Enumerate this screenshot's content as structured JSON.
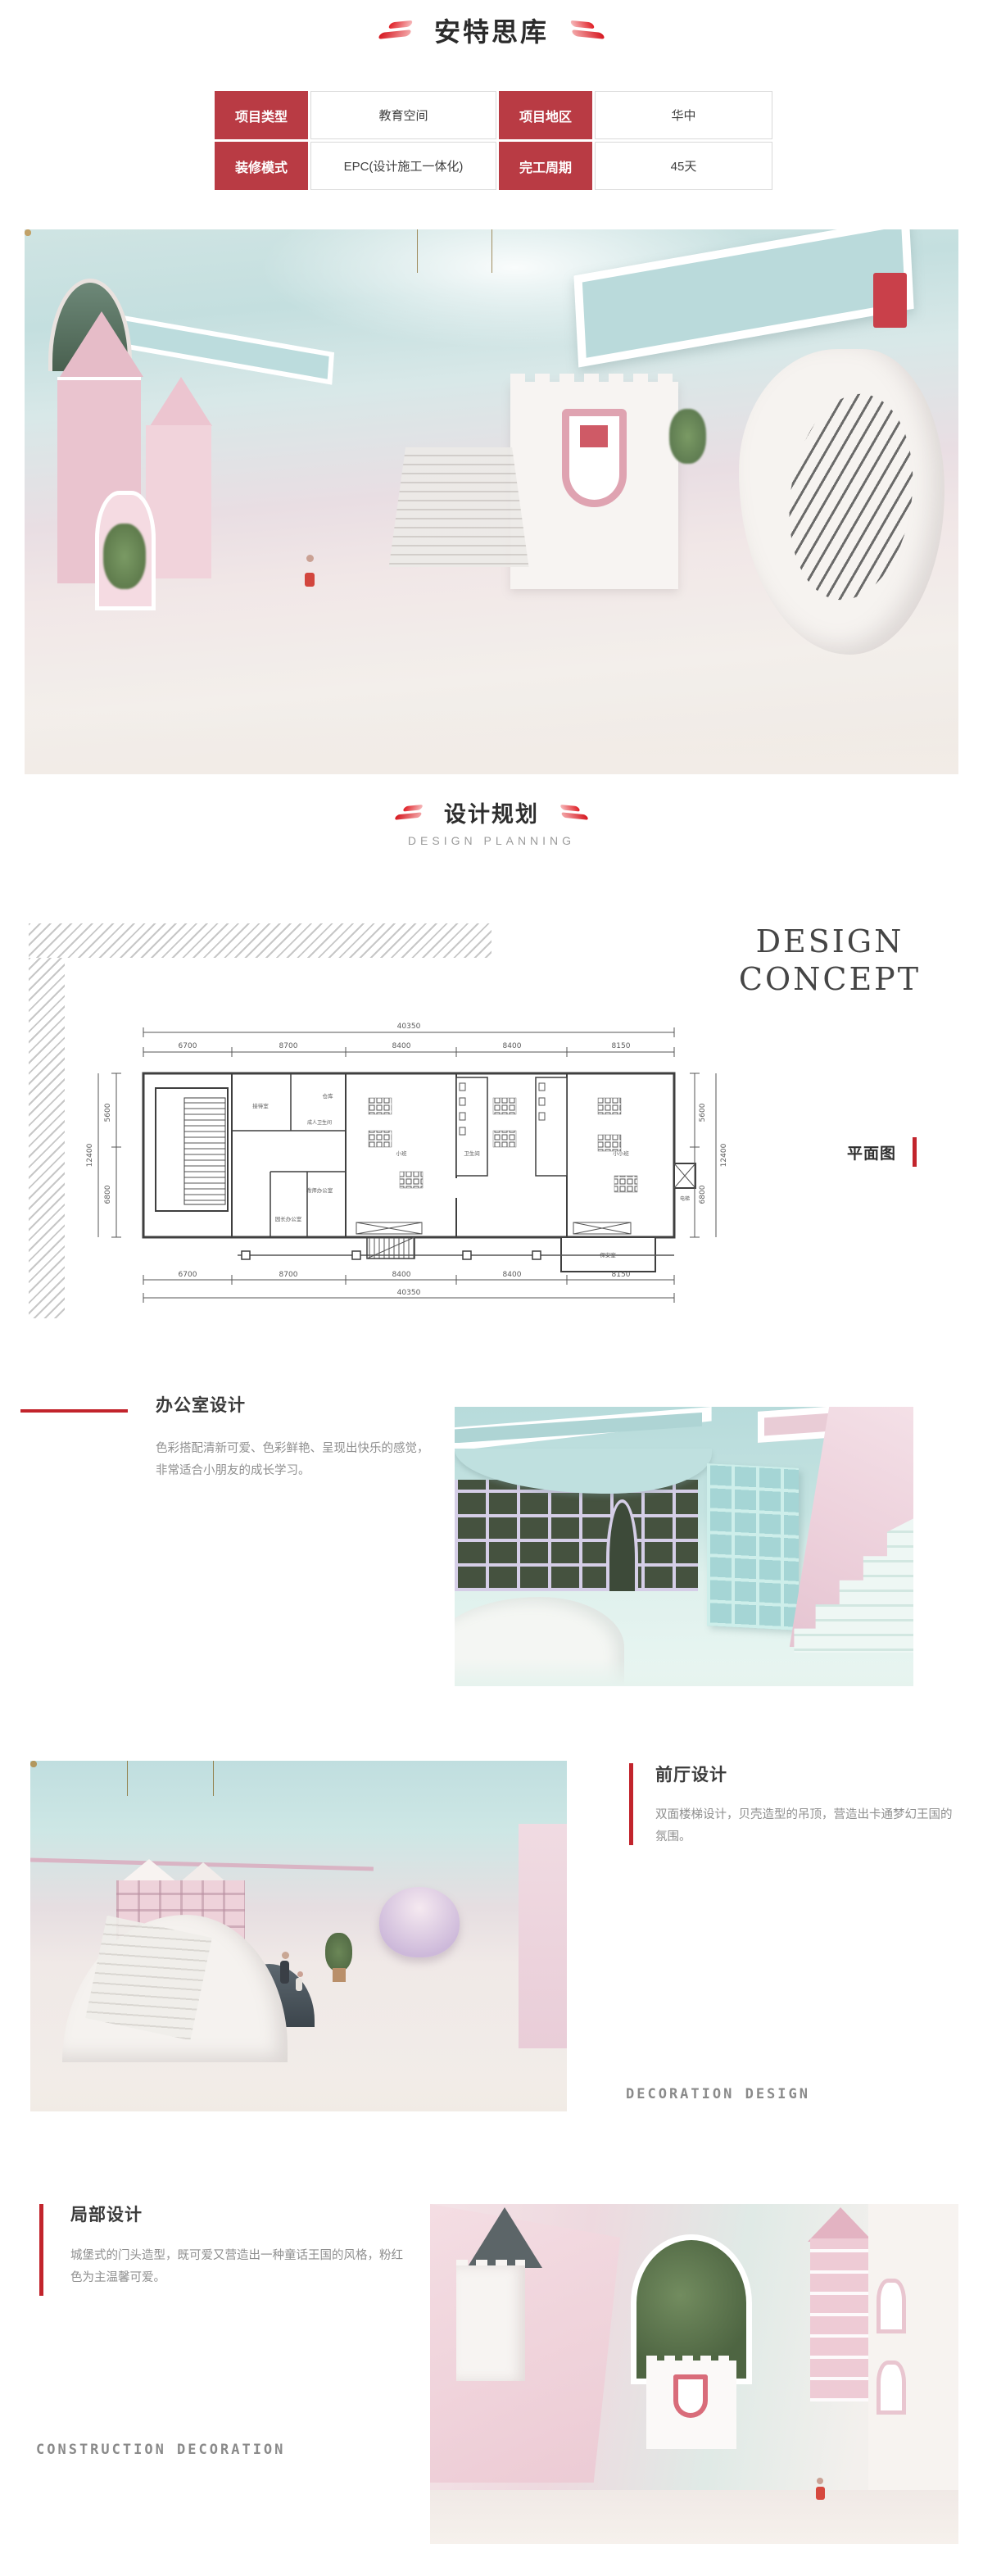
{
  "brand": {
    "title": "安特思库"
  },
  "info_table": {
    "rows": [
      [
        "项目类型",
        "教育空间",
        "项目地区",
        "华中"
      ],
      [
        "装修模式",
        "EPC(设计施工一体化)",
        "完工周期",
        "45天"
      ]
    ]
  },
  "planning_header": {
    "title": "设计规划",
    "subtitle": "DESIGN PLANNING"
  },
  "design_concept": {
    "line1": "DESIGN",
    "line2": "CONCEPT",
    "plan_label": "平面图"
  },
  "floor_plan": {
    "total_width": "40350",
    "top_segments": [
      "6700",
      "8700",
      "8400",
      "8400",
      "8150"
    ],
    "bottom_segments": [
      "6700",
      "8700",
      "8400",
      "8400",
      "8150"
    ],
    "total_width_bottom": "40350",
    "left_total": "12400",
    "left_segments": [
      "5600",
      "6800"
    ],
    "right_total": "12400",
    "right_segments": [
      "5600",
      "6800"
    ],
    "rooms": [
      "接待室",
      "成人卫生间",
      "仓库",
      "教师办公室",
      "园长办公室",
      "小班",
      "卫生间",
      "小小班",
      "保安室",
      "电梯"
    ]
  },
  "sections": {
    "office": {
      "title": "办公室设计",
      "body": "色彩搭配清新可爱、色彩鲜艳、呈现出快乐的感觉，非常适合小朋友的成长学习。"
    },
    "lobby": {
      "title": "前厅设计",
      "body": "双面楼梯设计，贝壳造型的吊顶，营造出卡通梦幻王国的氛围。",
      "caption": "DECORATION DESIGN"
    },
    "partial": {
      "title": "局部设计",
      "body": "城堡式的门头造型，既可爱又营造出一种童话王国的风格，粉红色为主温馨可爱。",
      "caption": "CONSTRUCTION DECORATION"
    }
  },
  "colors": {
    "accent_red": "#b93b44",
    "bright_red": "#c2242c",
    "text_dark": "#333333",
    "text_gray": "#8f8f8f"
  }
}
